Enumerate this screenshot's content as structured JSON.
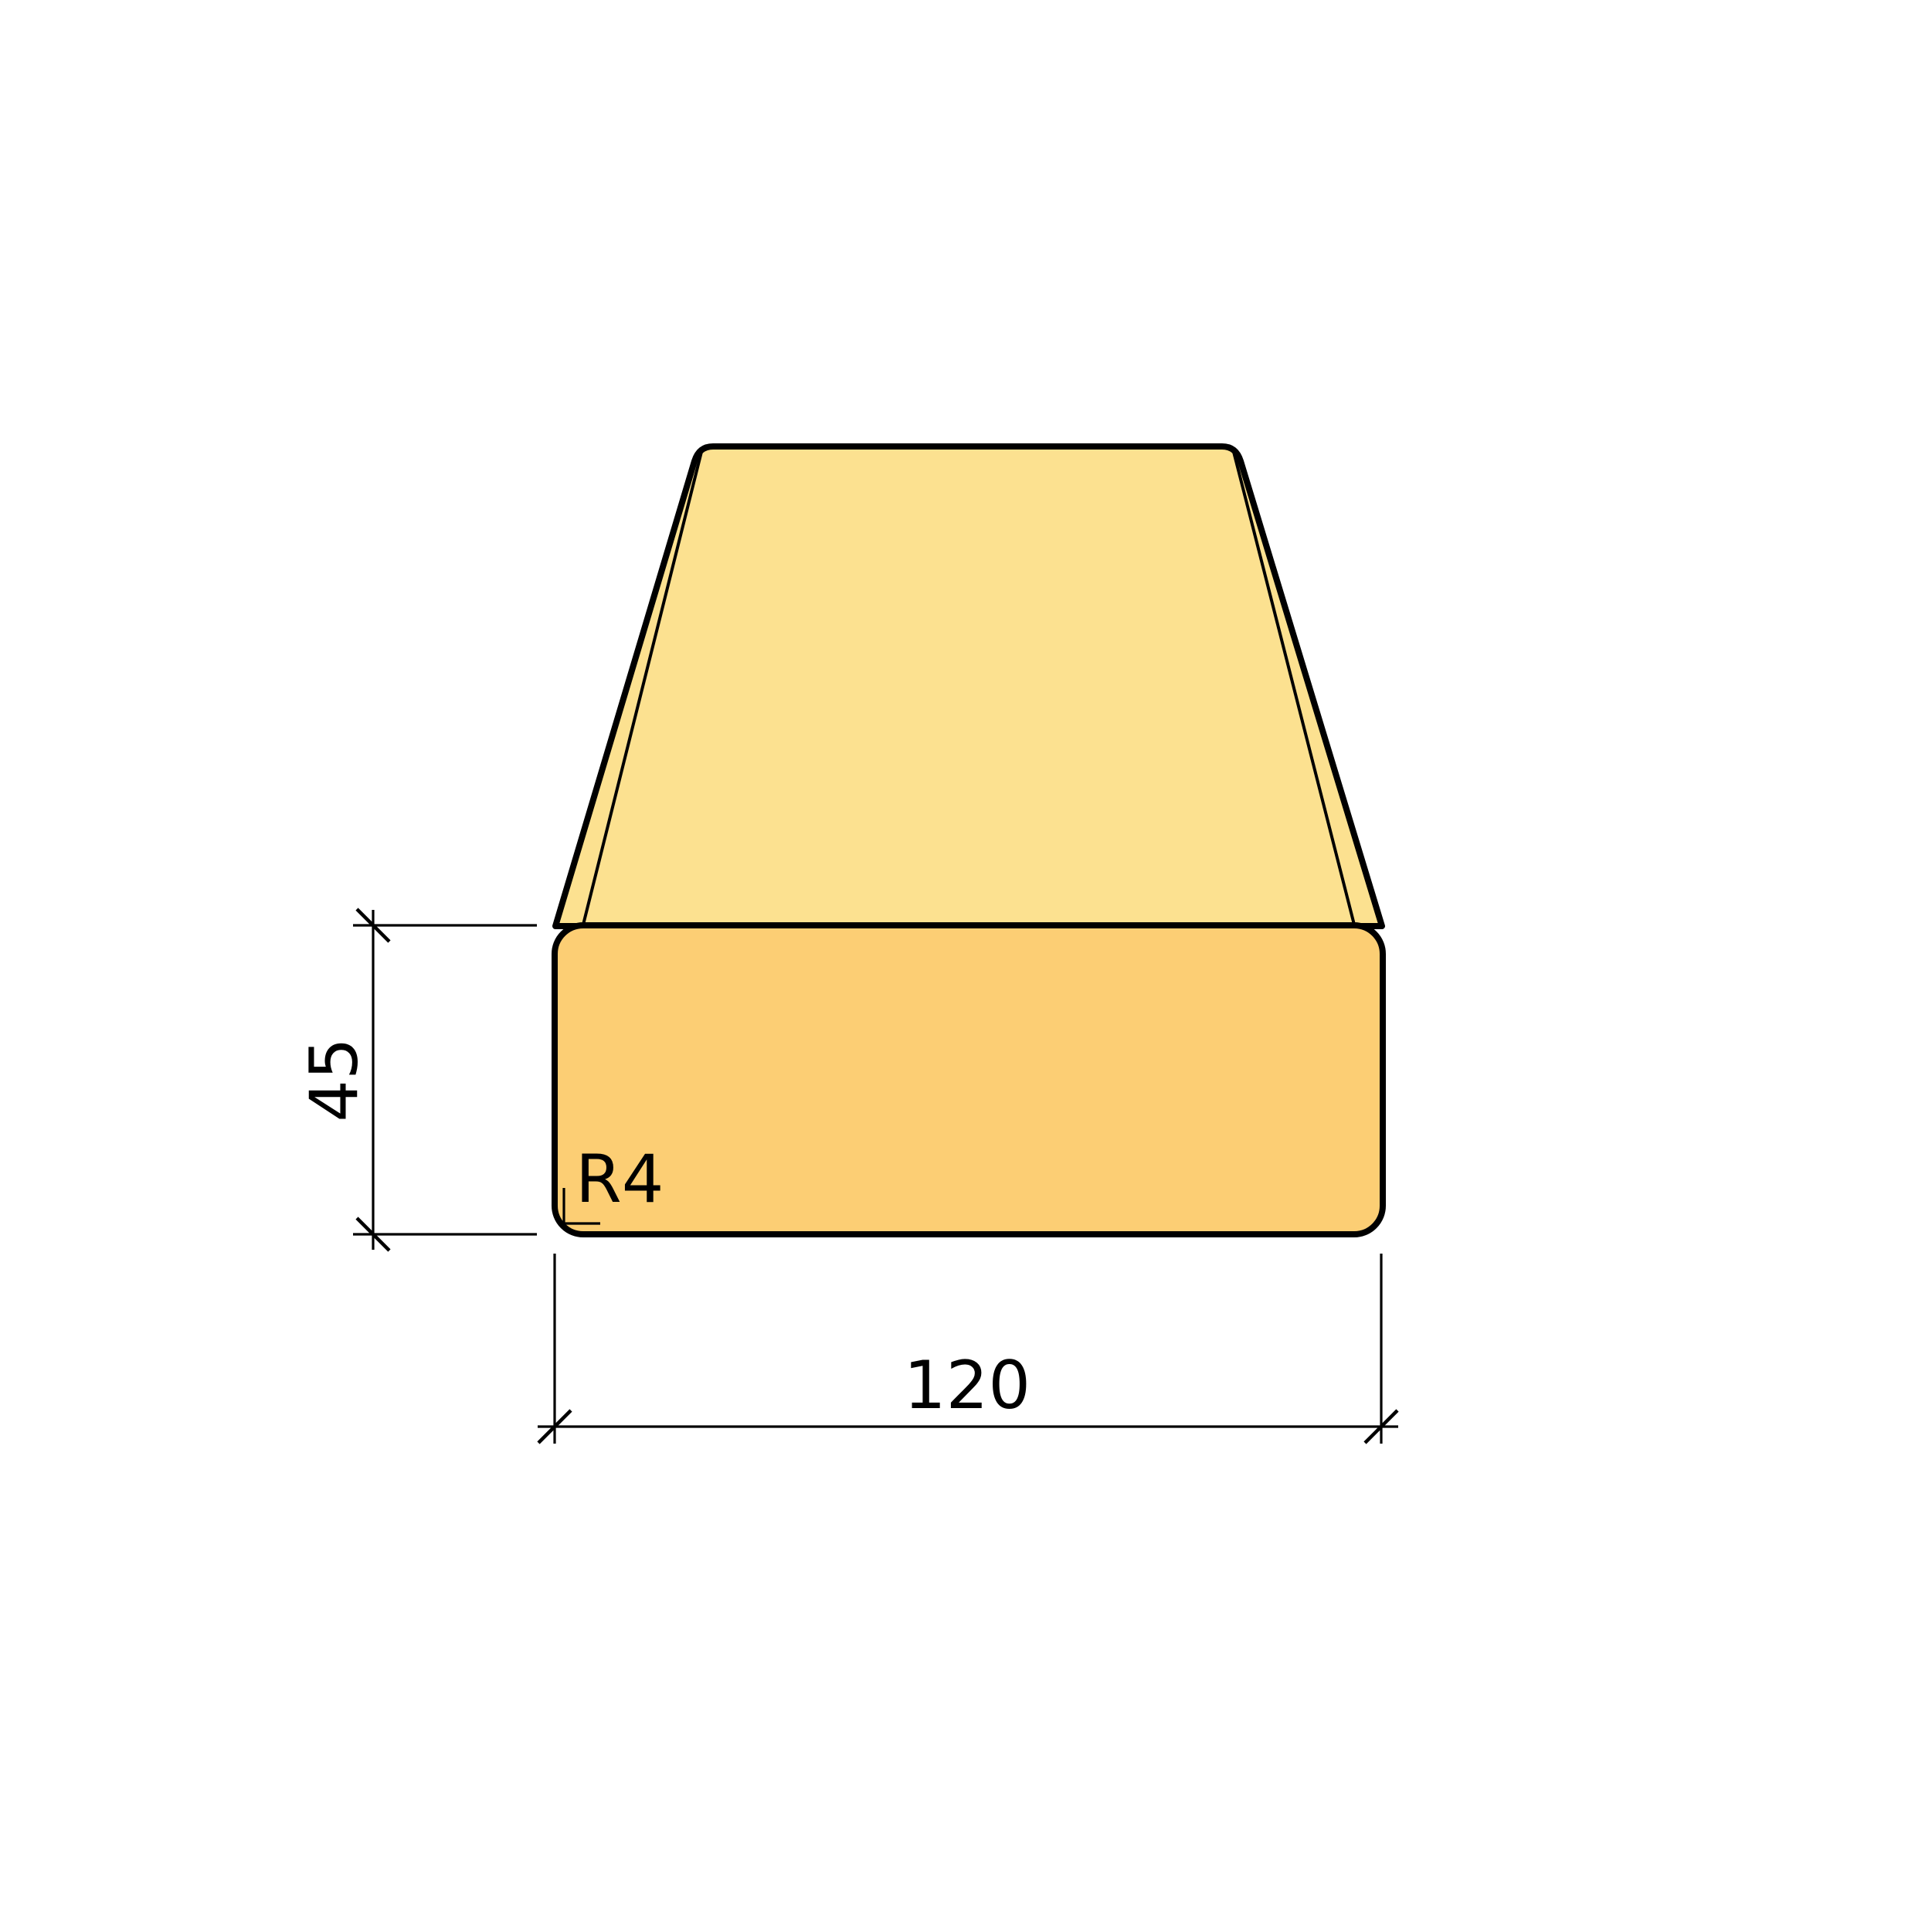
{
  "title": "Timber profile cross-section drawing",
  "drawing": {
    "part_name": "planed-timber-board",
    "view": "perspective-cross-section",
    "dimensions": {
      "width": {
        "value": "120"
      },
      "height": {
        "value": "45"
      },
      "corner_radius": {
        "value": "R4"
      }
    },
    "colors": {
      "top_face": "#FCE190",
      "front_face": "#FCCE74",
      "outline": "#000000",
      "background": "#FFFFFF"
    }
  }
}
